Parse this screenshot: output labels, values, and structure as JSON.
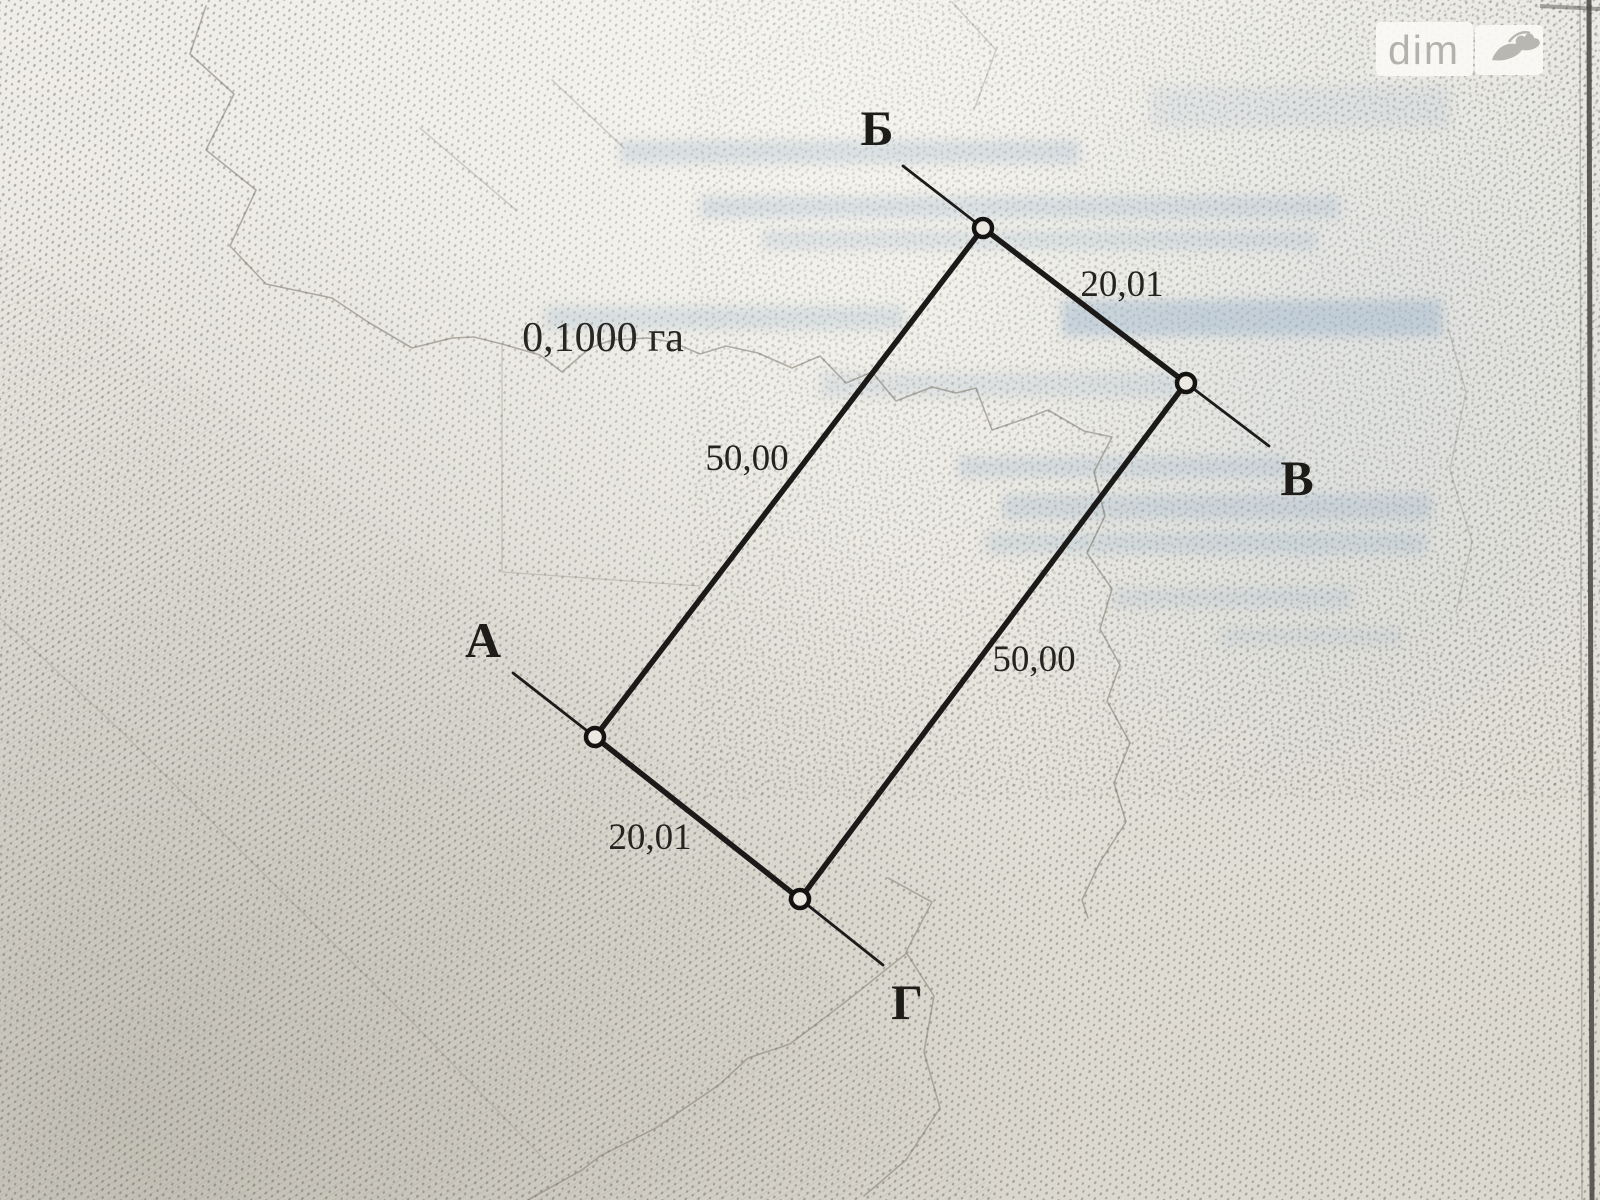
{
  "watermark": {
    "brand": "dim",
    "logo_icon": "ria-dove-icon"
  },
  "plot_plan": {
    "area": "0,1000 га",
    "corners": {
      "top": "Б",
      "right": "В",
      "left": "А",
      "bottom": "Г"
    },
    "side_lengths": {
      "top_right": "20,01",
      "left": "50,00",
      "right": "50,00",
      "bottom_left": "20,01"
    }
  },
  "colors": {
    "ink": "#1b1a18",
    "paper": "#e9e7e0",
    "showthrough_blue": "#9fb6cc",
    "terrain_line": "#7a766a",
    "watermark_text": "#b4b2ad",
    "page_border": "#46443f"
  }
}
